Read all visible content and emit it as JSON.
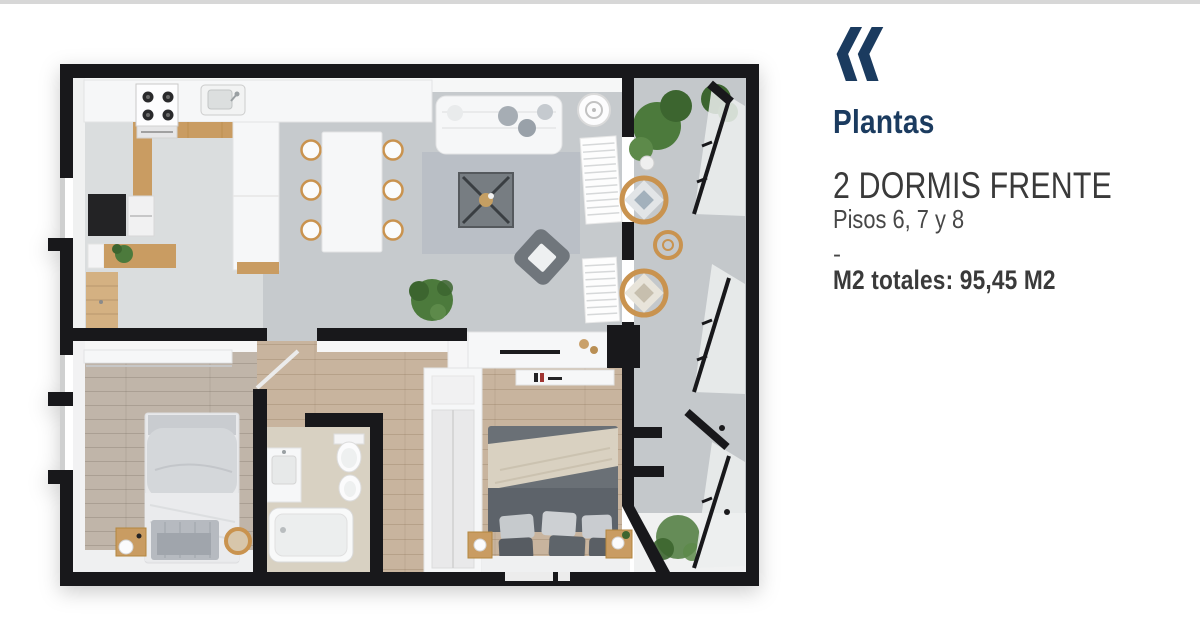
{
  "colors": {
    "accent": "#1b3b5f",
    "page_bg": "#ffffff",
    "top_rule": "#d7d7d7",
    "wall": "#18181b",
    "floor_living": "#c6cacd",
    "floor_kitchen": "#dfe1e2",
    "floor_wood": "#c0b5a9",
    "floor_wood_warm": "#c8b49e",
    "floor_bath": "#d8d1c2",
    "floor_balcony": "#c4c8cb",
    "wood": "#c99c62",
    "plant": "#4c7a3c",
    "plant_dark": "#3c652f",
    "rug": "#b7bdc4",
    "sofa_white": "#f6f7f8",
    "furniture_dark": "#6a7076",
    "blanket_beige": "#d9d1c1",
    "text_dark": "#3a3a3a",
    "text_mid": "#474747"
  },
  "logo": {
    "icon": "double-chevron-left"
  },
  "panel": {
    "title": "Plantas",
    "unit_name": "2 DORMIS FRENTE",
    "floors_line": "Pisos 6, 7 y 8",
    "separator": "-",
    "totals_label": "M2 totales:",
    "totals_value": "95,45 M2"
  }
}
